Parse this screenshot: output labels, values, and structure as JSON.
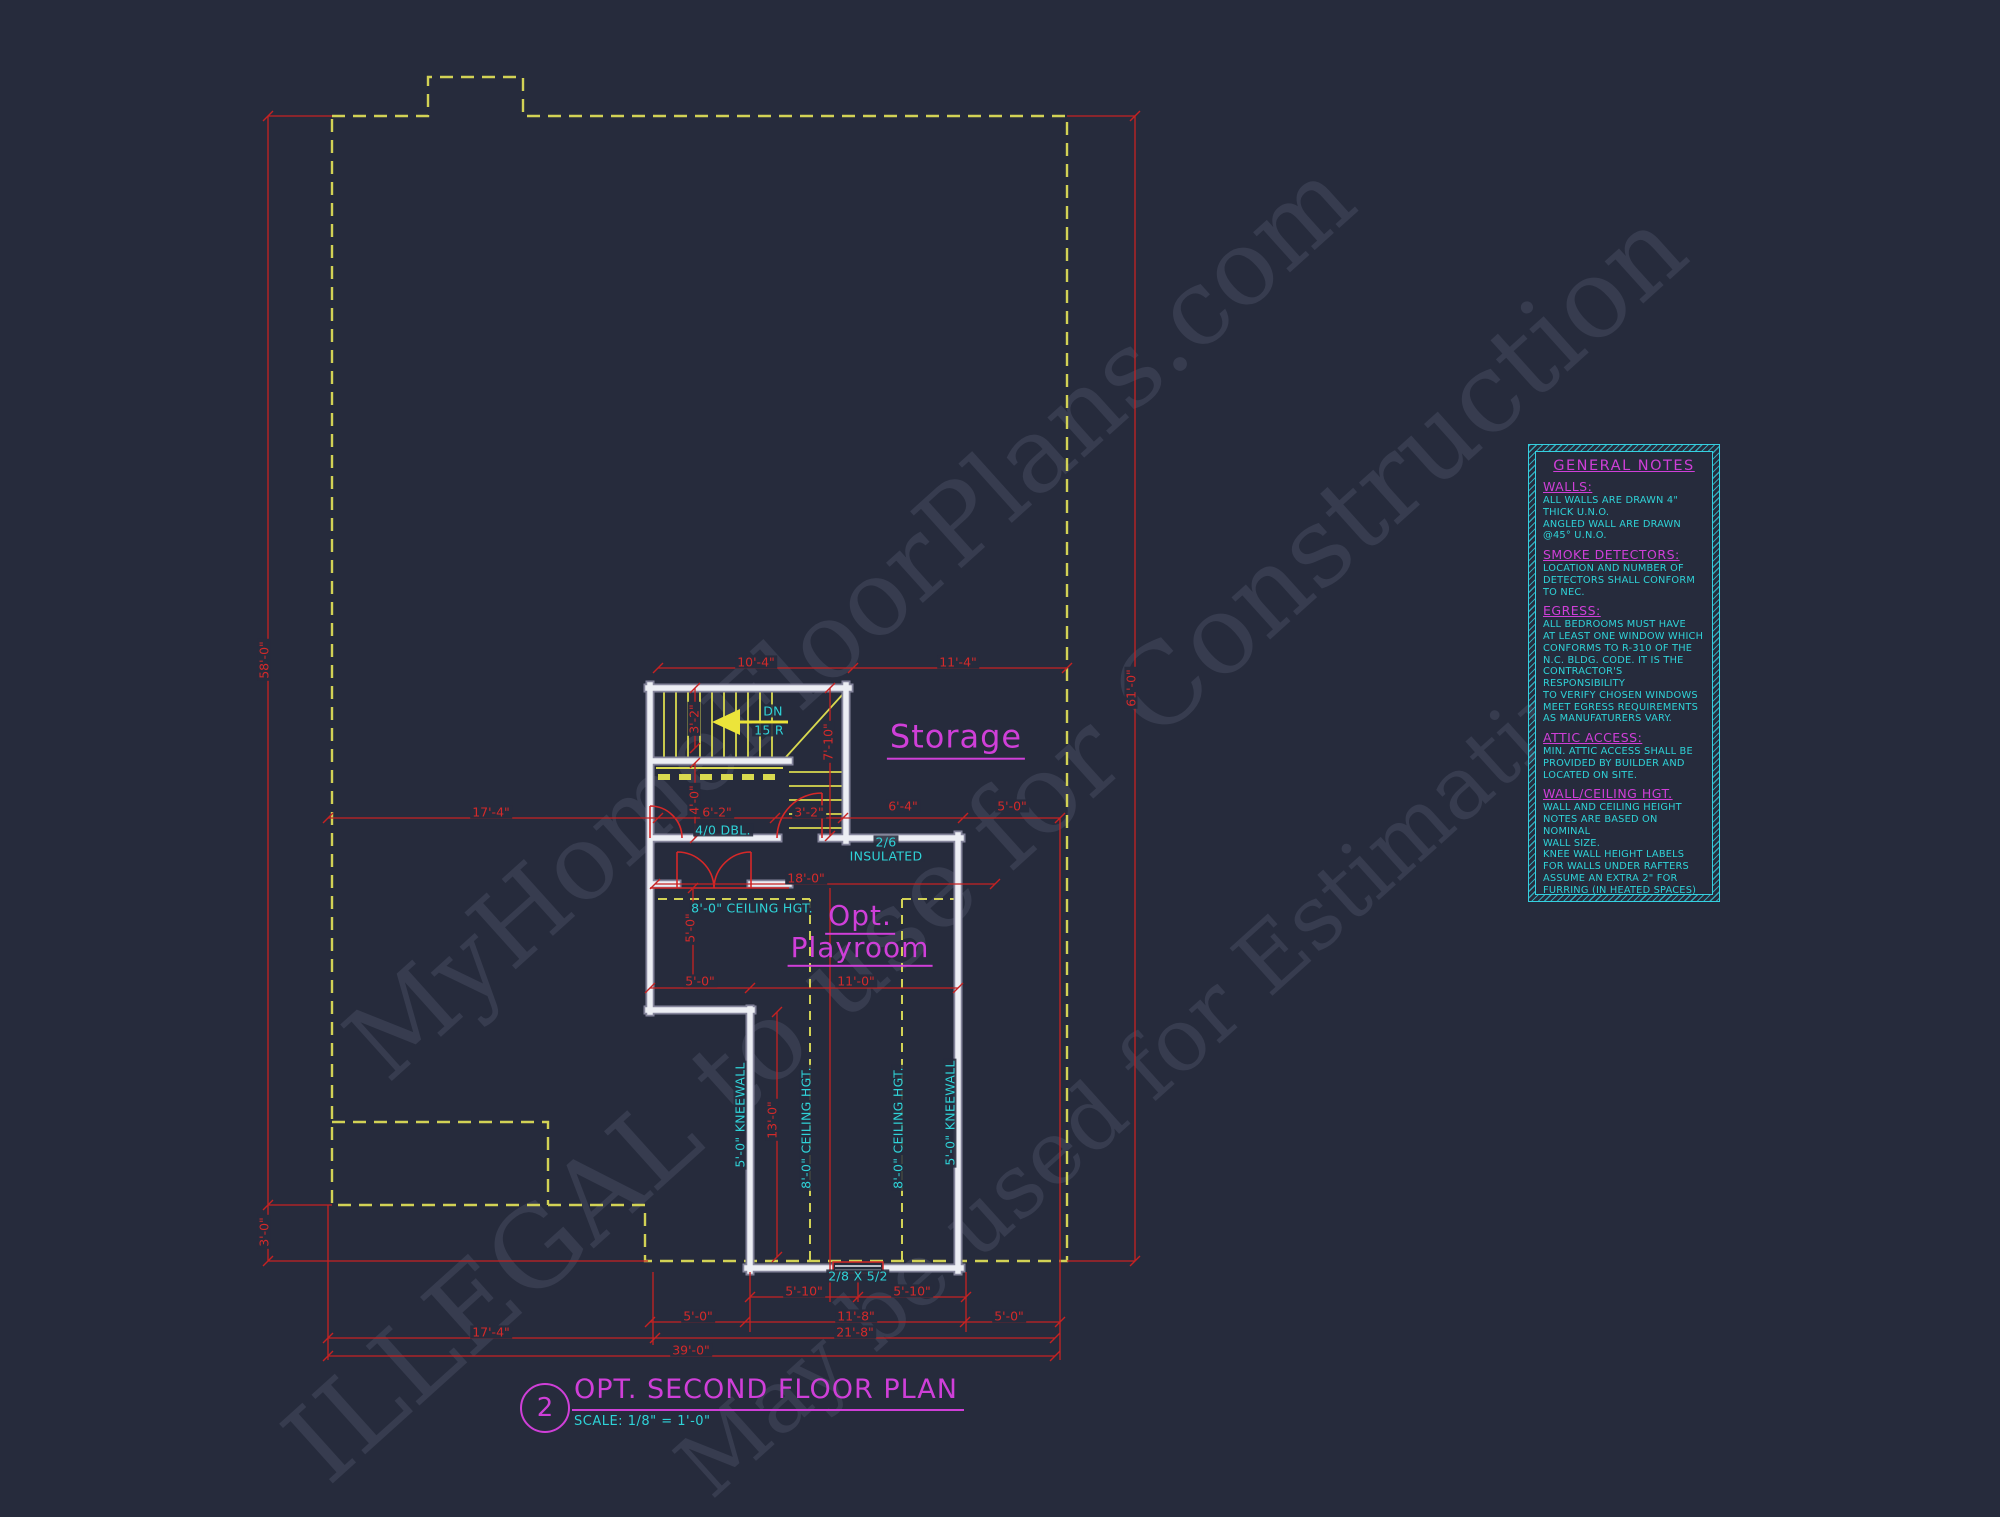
{
  "watermark": {
    "line1": "MyHomeFloorPlans.com",
    "line2": "ILLEGAL to use for Construction",
    "line3": "May be used for Estimating"
  },
  "title_block": {
    "number": "2",
    "title": "OPT. SECOND FLOOR PLAN",
    "scale": "SCALE: 1/8\" = 1'-0\""
  },
  "colors": {
    "background": "#262b3c",
    "dimension_red": "#d42a2a",
    "annotation_cyan": "#2fd3d8",
    "label_magenta": "#cf3fd8",
    "roofline_yellow": "#d2d255",
    "wall_white": "#eceef4"
  },
  "plan": {
    "room_labels": [
      {
        "t": "Storage",
        "x": 956,
        "y": 740,
        "fs": 32
      },
      {
        "t": "Opt.",
        "x": 860,
        "y": 918,
        "fs": 28
      },
      {
        "t": "Playroom",
        "x": 860,
        "y": 950,
        "fs": 28
      }
    ],
    "dim_labels": [
      {
        "t": "58'-0\"",
        "x": 264,
        "y": 660,
        "v": 1
      },
      {
        "t": "3'-0\"",
        "x": 264,
        "y": 1232,
        "v": 1
      },
      {
        "t": "61'-0\"",
        "x": 1131,
        "y": 688,
        "v": 1
      },
      {
        "t": "17'-4\"",
        "x": 491,
        "y": 812
      },
      {
        "t": "10'-4\"",
        "x": 756,
        "y": 662
      },
      {
        "t": "11'-4\"",
        "x": 958,
        "y": 662
      },
      {
        "t": "6'-2\"",
        "x": 717,
        "y": 812
      },
      {
        "t": "3'-2\"",
        "x": 809,
        "y": 812
      },
      {
        "t": "6'-4\"",
        "x": 903,
        "y": 806
      },
      {
        "t": "5'-0\"",
        "x": 1012,
        "y": 806
      },
      {
        "t": "3'-2\"",
        "x": 694,
        "y": 719,
        "v": 1
      },
      {
        "t": "7'-10\"",
        "x": 828,
        "y": 742,
        "v": 1
      },
      {
        "t": "4'-0\"",
        "x": 694,
        "y": 800,
        "v": 1
      },
      {
        "t": "18'-0\"",
        "x": 806,
        "y": 878
      },
      {
        "t": "5'-0\"",
        "x": 690,
        "y": 928,
        "v": 1
      },
      {
        "t": "5'-0\"",
        "x": 700,
        "y": 981
      },
      {
        "t": "11'-0\"",
        "x": 856,
        "y": 981
      },
      {
        "t": "13'-0\"",
        "x": 772,
        "y": 1120,
        "v": 1
      },
      {
        "t": "5'-10\"",
        "x": 804,
        "y": 1291
      },
      {
        "t": "5'-10\"",
        "x": 912,
        "y": 1291
      },
      {
        "t": "5'-0\"",
        "x": 698,
        "y": 1316
      },
      {
        "t": "11'-8\"",
        "x": 856,
        "y": 1316
      },
      {
        "t": "5'-0\"",
        "x": 1009,
        "y": 1316
      },
      {
        "t": "17'-4\"",
        "x": 491,
        "y": 1332
      },
      {
        "t": "21'-8\"",
        "x": 855,
        "y": 1332
      },
      {
        "t": "39'-0\"",
        "x": 691,
        "y": 1350
      }
    ],
    "annotations": [
      {
        "t": "DN",
        "x": 773,
        "y": 711
      },
      {
        "t": "15 R",
        "x": 769,
        "y": 730
      },
      {
        "t": "4/0 DBL.",
        "x": 723,
        "y": 830
      },
      {
        "t": "2/6",
        "x": 886,
        "y": 842
      },
      {
        "t": "INSULATED",
        "x": 886,
        "y": 856
      },
      {
        "t": "8'-0\" CEILING HGT.",
        "x": 752,
        "y": 908
      },
      {
        "t": "8'-0\" CEILING HGT.",
        "x": 806,
        "y": 1128,
        "v": 1
      },
      {
        "t": "8'-0\" CEILING HGT.",
        "x": 898,
        "y": 1128,
        "v": 1
      },
      {
        "t": "5'-0\" KNEEWALL",
        "x": 740,
        "y": 1115,
        "v": 1
      },
      {
        "t": "5'-0\" KNEEWALL",
        "x": 950,
        "y": 1113,
        "v": 1
      },
      {
        "t": "2/8 X 5/2",
        "x": 858,
        "y": 1276
      }
    ]
  },
  "notes": {
    "title": "GENERAL NOTES",
    "sections": [
      {
        "heading": "WALLS:",
        "body": "ALL WALLS ARE DRAWN 4\"\nTHICK U.N.O.\nANGLED WALL ARE DRAWN\n@45° U.N.O."
      },
      {
        "heading": "SMOKE DETECTORS:",
        "body": "LOCATION AND NUMBER OF\nDETECTORS SHALL CONFORM\nTO NEC."
      },
      {
        "heading": "EGRESS:",
        "body": "ALL BEDROOMS MUST HAVE\nAT LEAST ONE WINDOW WHICH\nCONFORMS TO R-310 OF THE\nN.C. BLDG. CODE. IT IS THE\nCONTRACTOR'S RESPONSIBILITY\nTO VERIFY CHOSEN WINDOWS\nMEET EGRESS REQUIREMENTS\nAS MANUFATURERS VARY."
      },
      {
        "heading": "ATTIC ACCESS:",
        "body": "MIN. ATTIC ACCESS SHALL BE\nPROVIDED BY BUILDER AND\nLOCATED ON SITE."
      },
      {
        "heading": "WALL/CEILING HGT.",
        "body": "WALL AND CEILING HEIGHT\nNOTES ARE BASED ON NOMINAL\nWALL SIZE.\nKNEE WALL HEIGHT LABELS\nFOR WALLS UNDER RAFTERS\nASSUME AN EXTRA 2\" FOR\nFURRING (IN HEATED SPACES)\nFOR INSULATION. THE WALL\nHEIGHT REFERS TO THE HGT.\nFROM THE FLOOR DECKING TO\nTHE BOTTOM OF THE FURRING."
      }
    ]
  }
}
